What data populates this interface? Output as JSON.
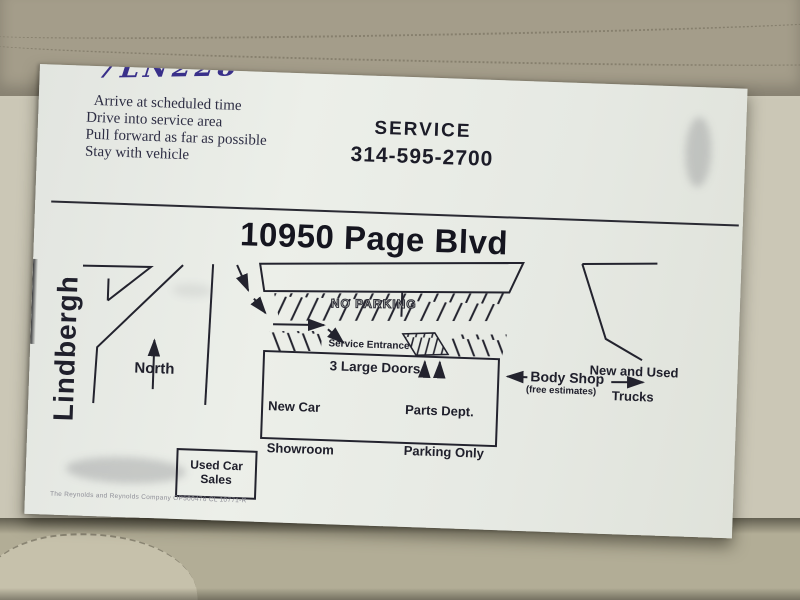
{
  "handwriting": "7LN228",
  "instructions": [
    "Arrive at scheduled time",
    "Drive into service area",
    "Pull forward as far as possible",
    "Stay with vehicle"
  ],
  "service": {
    "title": "SERVICE",
    "phone": "314-595-2700"
  },
  "address": "10950 Page Blvd",
  "map": {
    "street_left": "Lindbergh",
    "compass": "North",
    "no_parking": "NO PARKING",
    "service_entrance": "Service Entrance",
    "doors": "3 Large Doors",
    "new_car_line1": "New Car",
    "new_car_line2": "Showroom",
    "parts_line1": "Parts Dept.",
    "parts_line2": "Parking Only",
    "body_shop": "Body Shop",
    "body_shop_sub": "(free estimates)",
    "trucks_line1": "New and Used",
    "trucks_line2": "Trucks",
    "used_car_sales": "Used Car Sales"
  },
  "fine_print": "The Reynolds and Reynolds Company OP500476 CL 10771-R",
  "colors": {
    "card": "#e7eae5",
    "ink": "#20202c",
    "pen_ink": "#39308a",
    "seat_top": "#a49d8a",
    "seat_main": "#cbc7b6",
    "seat_bottom": "#b2ad96"
  }
}
